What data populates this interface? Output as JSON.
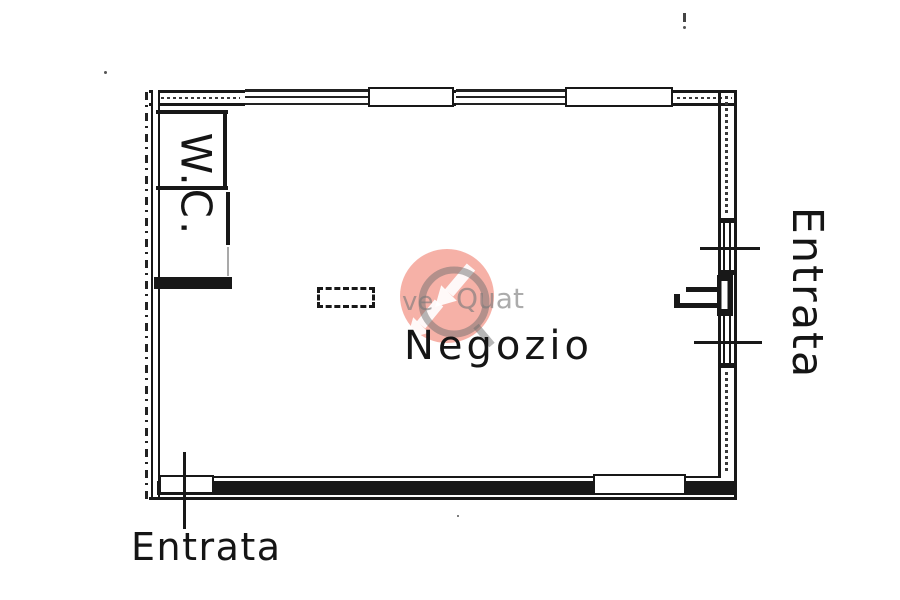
{
  "labels": {
    "room": "Negozio",
    "wc": "W.C.",
    "entrance_bottom": "Entrata",
    "entrance_right": "Entrata"
  },
  "watermark": {
    "fragment_left": "ve",
    "fragment_right": "Quat",
    "circle_color": "#ee6a56",
    "arrow_color": "#ffffff",
    "ring_color": "#6f6f6f",
    "text_color": "#7a7a7a"
  },
  "ink_color": "#181818"
}
